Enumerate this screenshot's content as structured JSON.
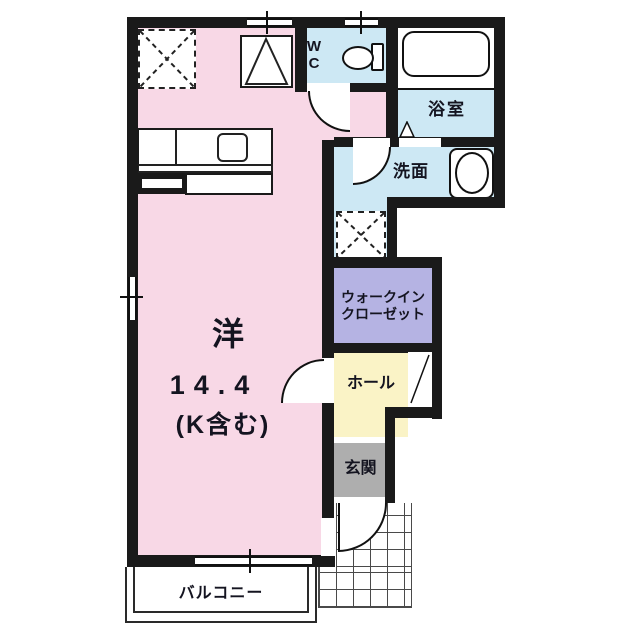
{
  "title": "1R apartment floor plan",
  "palette": {
    "pink": "#f8d8e6",
    "blue": "#cde8f4",
    "lavender": "#b5b3e3",
    "yellow": "#faf3c6",
    "gray": "#aeaeae",
    "wall": "#1a1a1a"
  },
  "rooms": {
    "main": {
      "name": "洋",
      "area": "14.4",
      "area_note": "(K含む)"
    },
    "wc": {
      "label": "W\nC"
    },
    "bathroom": {
      "label": "浴室"
    },
    "washroom": {
      "label": "洗面"
    },
    "walk_in_closet": {
      "label_line1": "ウォークイン",
      "label_line2": "クローゼット"
    },
    "hall": {
      "label": "ホール"
    },
    "entrance": {
      "label": "玄関"
    },
    "balcony": {
      "label": "バルコニー"
    }
  }
}
